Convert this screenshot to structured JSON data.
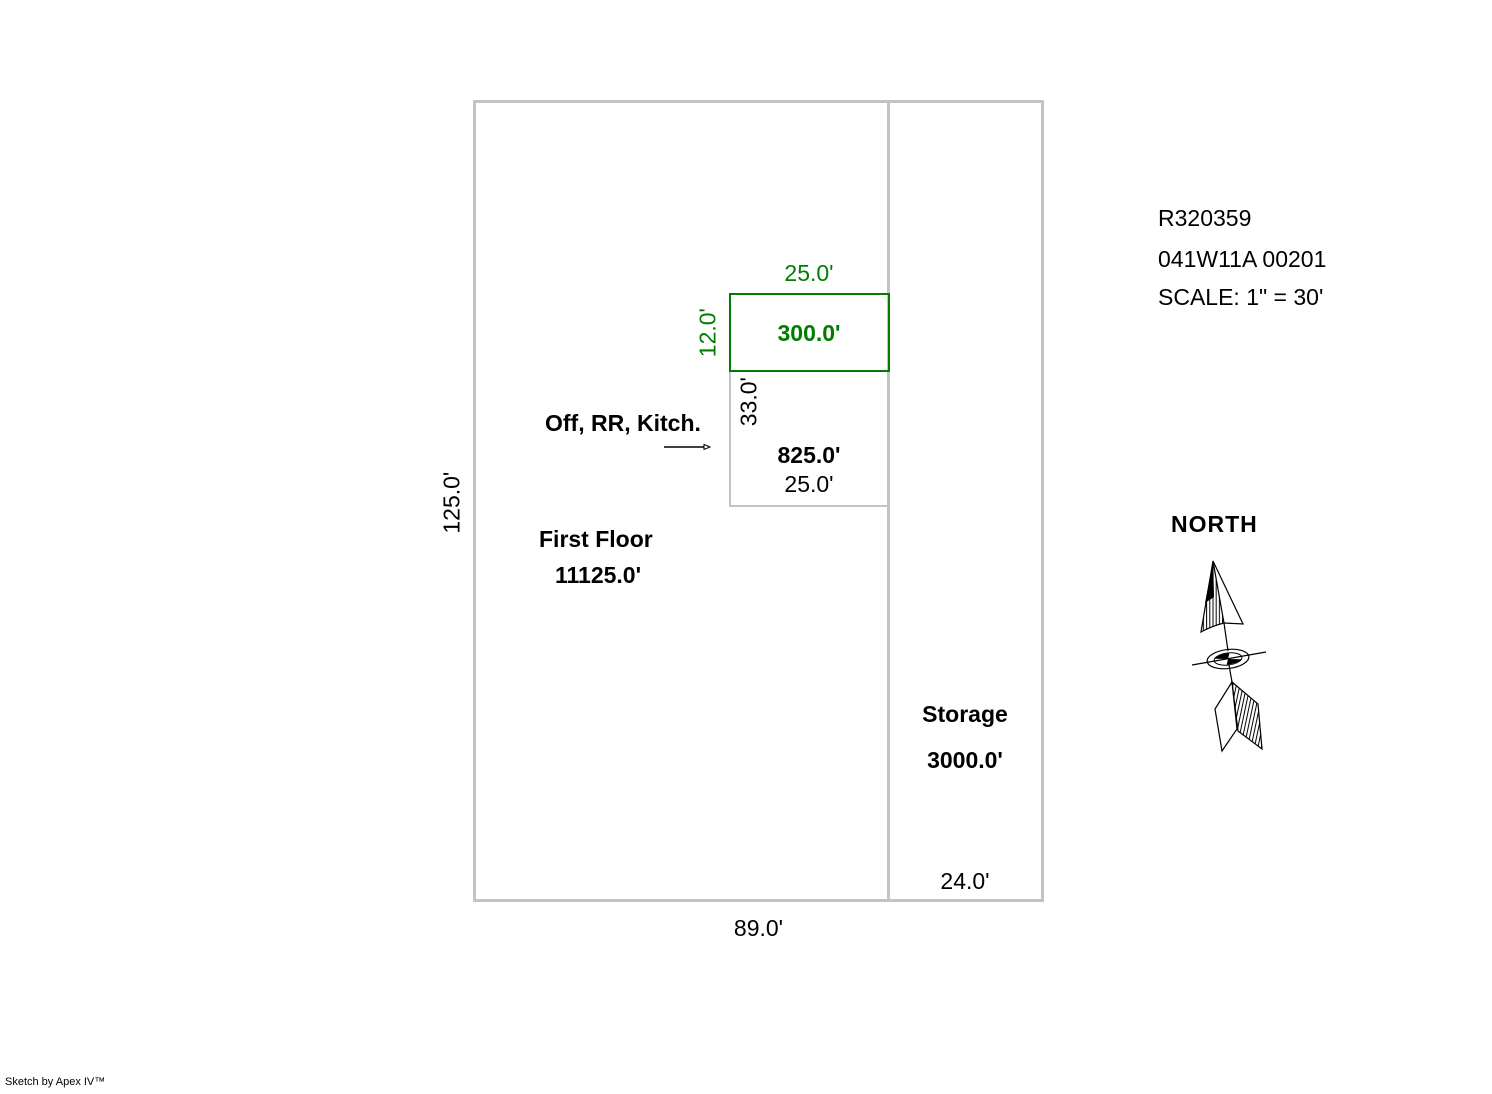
{
  "info": {
    "account": "R320359",
    "map_taxlot": "041W11A 00201",
    "scale": "SCALE: 1\" = 30'"
  },
  "north_label": "NORTH",
  "areas": {
    "first_floor": {
      "label": "First Floor",
      "area": "11125.0'",
      "bottom_dim": "89.0'",
      "left_dim": "125.0'"
    },
    "storage": {
      "label": "Storage",
      "area": "3000.0'",
      "bottom_dim": "24.0'"
    },
    "green_addition": {
      "area": "300.0'",
      "top_dim": "25.0'",
      "left_dim": "12.0'"
    },
    "office": {
      "label": "Off, RR, Kitch.",
      "area": "825.0'",
      "bottom_dim": "25.0'",
      "left_dim": "33.0'"
    }
  },
  "colors": {
    "outline_gray": "#c3c3c3",
    "addition_green": "#007d00"
  },
  "watermark": "Sketch by Apex IV™"
}
